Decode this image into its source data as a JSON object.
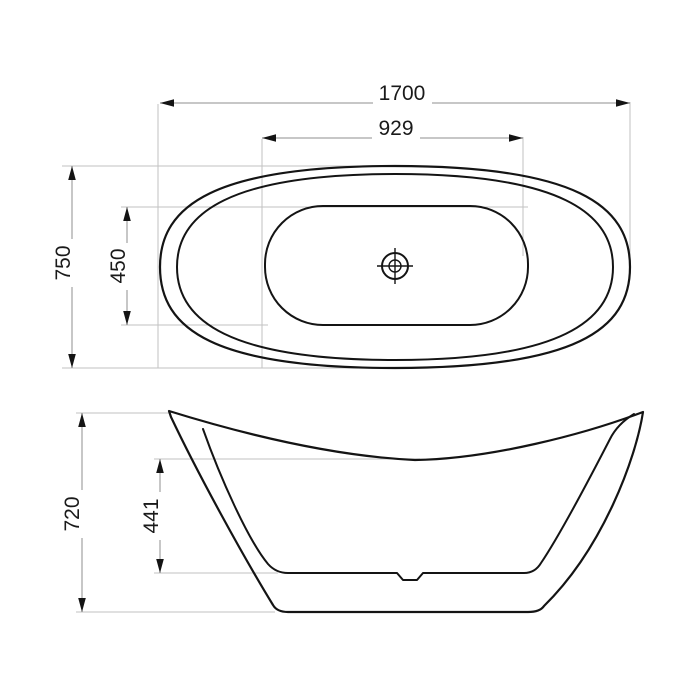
{
  "drawing": {
    "type": "bathtub-technical-drawing",
    "colors": {
      "background": "#ffffff",
      "outline": "#141414",
      "dimension_line": "#8f8f8f",
      "extension_line": "#c2c2c2",
      "arrow": "#141414",
      "label_text": "#1a1a1a"
    },
    "top_view": {
      "dimensions": {
        "overall_length": "1700",
        "inner_length": "929",
        "overall_width": "750",
        "inner_width": "450"
      }
    },
    "side_view": {
      "dimensions": {
        "overall_height": "720",
        "inner_depth": "441"
      }
    }
  }
}
